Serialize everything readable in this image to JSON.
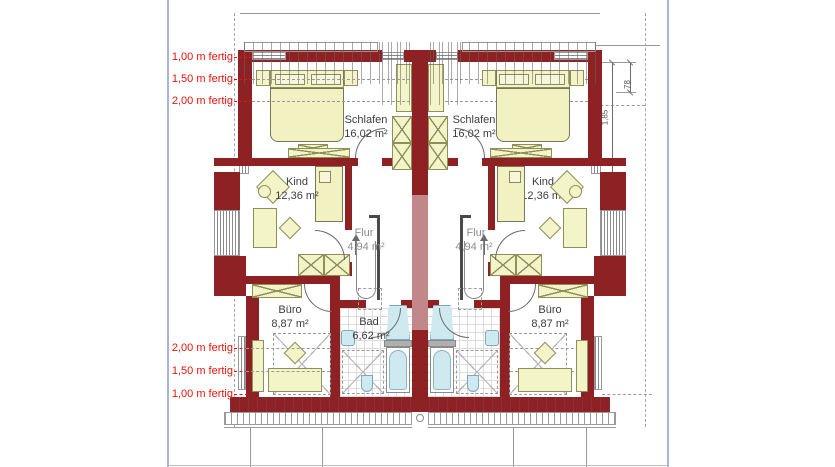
{
  "plan": {
    "height_labels": {
      "top": [
        "1,00 m fertig",
        "1,50 m fertig",
        "2,00 m fertig"
      ],
      "bottom": [
        "2,00 m fertig",
        "1,50 m fertig",
        "1,00 m fertig"
      ]
    },
    "units": [
      {
        "side": "left",
        "rooms": [
          {
            "name": "Schlafen",
            "area": "16,02 m²"
          },
          {
            "name": "Kind",
            "area": "12,36 m²"
          },
          {
            "name": "Flur",
            "area": "4,94 m²"
          },
          {
            "name": "Büro",
            "area": "8,87 m²"
          },
          {
            "name": "Bad",
            "area": "6,62 m²"
          }
        ]
      },
      {
        "side": "right",
        "rooms": [
          {
            "name": "Schlafen",
            "area": "16,02 m²"
          },
          {
            "name": "Kind",
            "area": "12,36 m²"
          },
          {
            "name": "Flur",
            "area": "4,94 m²"
          },
          {
            "name": "Büro",
            "area": "8,87 m²"
          },
          {
            "name": "Bad",
            "area": "6,62 m²"
          }
        ]
      }
    ],
    "dimensions": [
      "1,85",
      "78"
    ],
    "colors": {
      "wall": "#8e2124",
      "wall_light": "#c28789",
      "furniture": "#f4f4c9",
      "water": "#cfe9f1",
      "label_red": "#e8130c",
      "page_line": "#aab3da"
    }
  }
}
